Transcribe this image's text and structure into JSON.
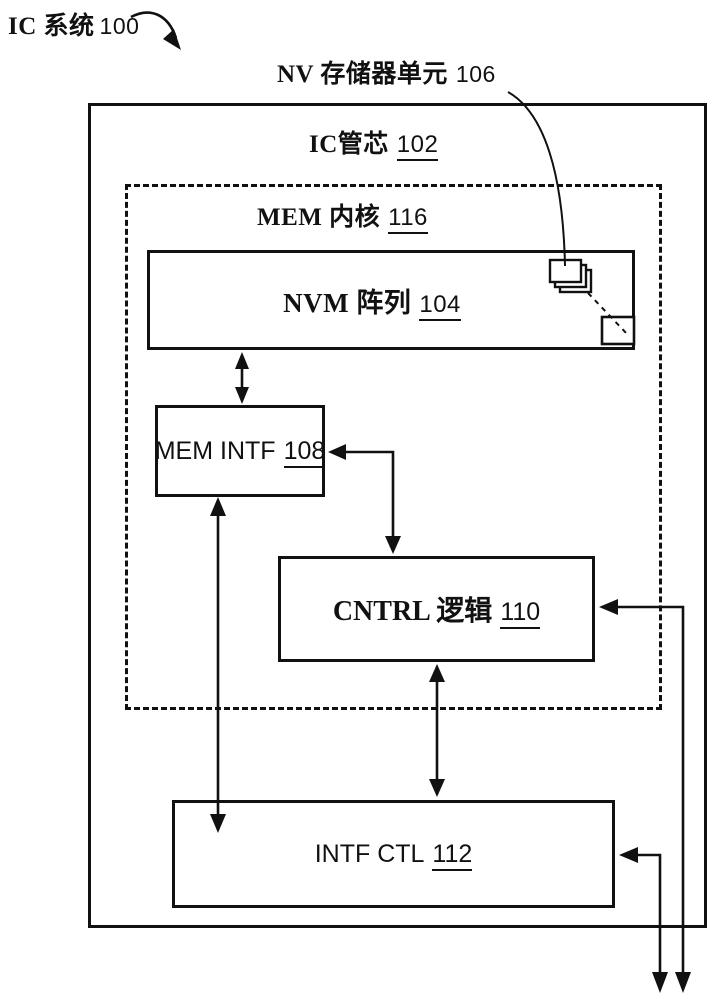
{
  "figure": {
    "type": "block-diagram",
    "language": "zh",
    "colors": {
      "line": "#111111",
      "background": "#ffffff"
    }
  },
  "labels": {
    "system": {
      "text": "IC 系统",
      "ref": "100"
    },
    "nv_unit": {
      "text": "NV 存储器单元",
      "ref": "106"
    },
    "die": {
      "text": "IC管芯",
      "ref": "102"
    },
    "mem_core": {
      "text": "MEM 内核",
      "ref": "116"
    },
    "nvm_array": {
      "text": "NVM 阵列",
      "ref": "104"
    },
    "mem_intf": {
      "text": "MEM INTF",
      "ref": "108"
    },
    "cntrl_logic": {
      "text": "CNTRL 逻辑",
      "ref": "110"
    },
    "intf_ctl": {
      "text": "INTF CTL",
      "ref": "112"
    }
  }
}
